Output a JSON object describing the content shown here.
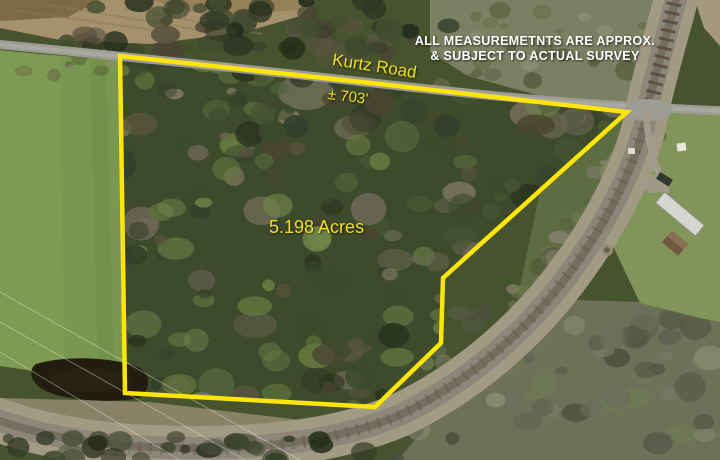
{
  "annotations": {
    "disclaimer_line1": "ALL MEASUREMETNTS ARE APPROX.",
    "disclaimer_line2": "& SUBJECT TO ACTUAL SURVEY",
    "road_label": "Kurtz Road",
    "frontage_label": "± 703'",
    "acreage_label": "5.198 Acres"
  },
  "boundary": {
    "color": "#ffe608",
    "points": "120,56 380,84 627,112 443,278 441,343 375,407 125,393"
  },
  "palette": {
    "label_yellow": "#f2df1e",
    "disclaimer_white": "#ffffff",
    "boundary_yellow": "#ffe608"
  },
  "features": [
    "aerial-photo",
    "kurtz-road",
    "railroad-track",
    "forest-parcel",
    "green-field",
    "pond",
    "dirt-field",
    "mobile-home",
    "shed",
    "lawn"
  ]
}
